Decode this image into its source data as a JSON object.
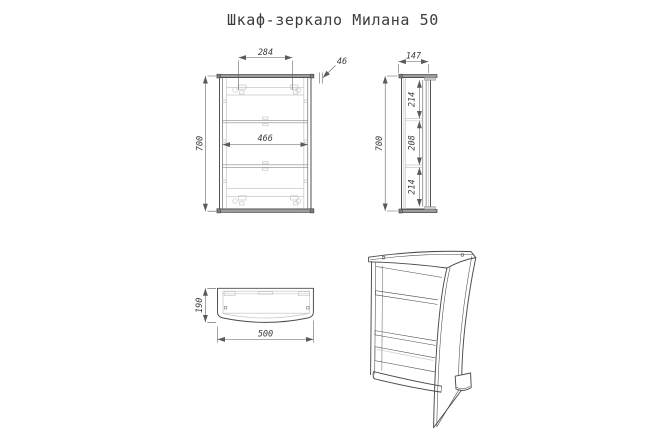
{
  "title": "Шкаф-зеркало Милана 50",
  "colors": {
    "line": "#4a4a4a",
    "light_detail": "#c7c7c7",
    "dimension_line": "#5a5a5a",
    "panel_fill": "#9c9c9c",
    "text": "#3b3b3b",
    "background": "#ffffff"
  },
  "views": {
    "front": {
      "dims": {
        "hinge_spacing": "284",
        "top_panel_thickness": "46",
        "inner_width": "466",
        "overall_height": "700"
      }
    },
    "side": {
      "dims": {
        "overall_depth": "147",
        "section_top": "214",
        "section_middle": "208",
        "section_bottom": "214",
        "overall_height": "700"
      }
    },
    "top": {
      "dims": {
        "overall_depth": "190",
        "overall_width": "500"
      }
    }
  }
}
